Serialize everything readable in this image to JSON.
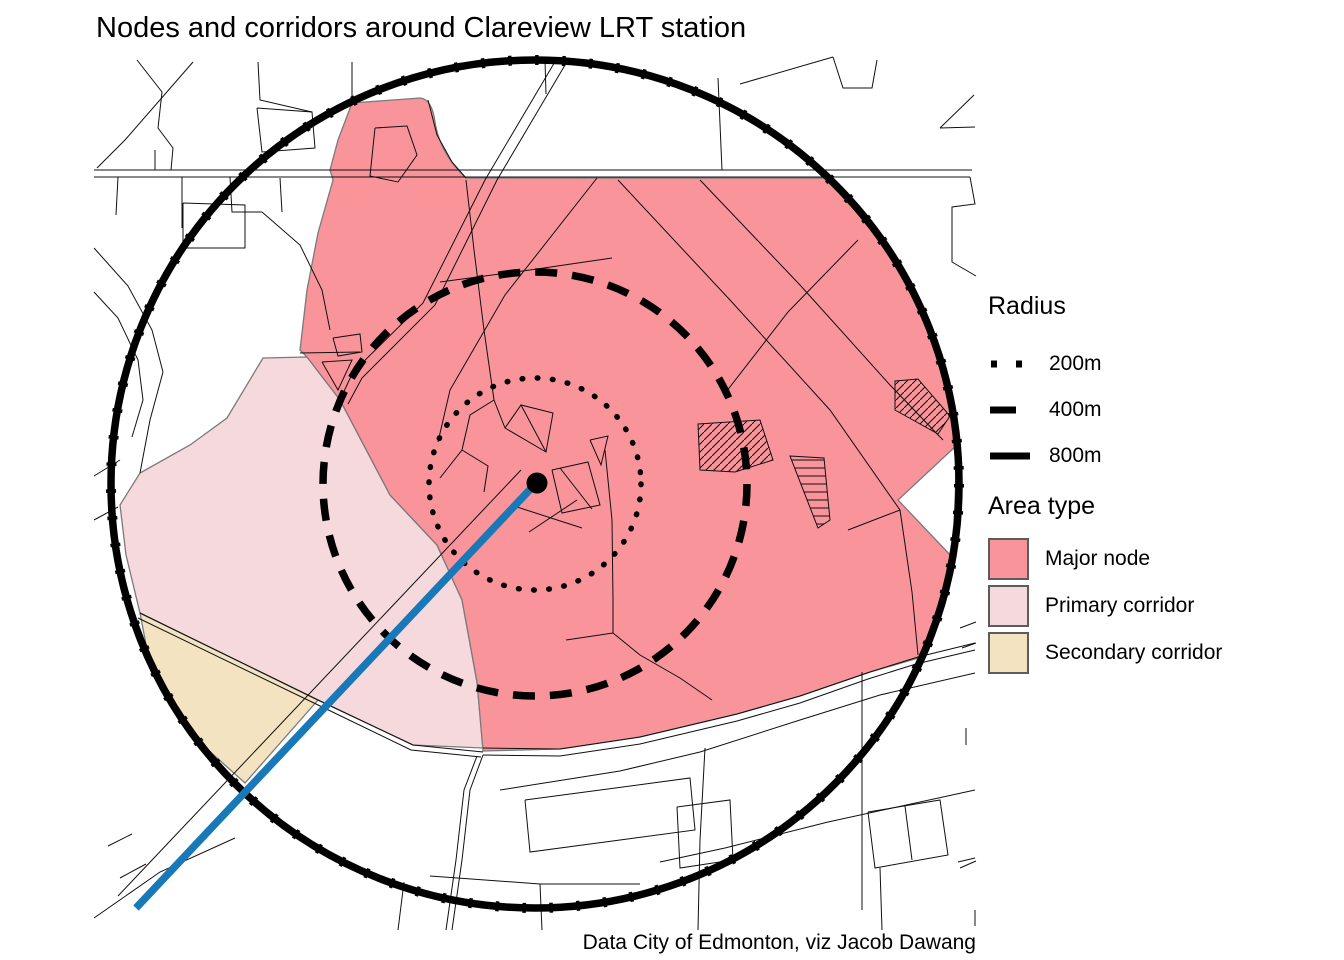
{
  "title": "Nodes and corridors around Clareview LRT station",
  "caption": "Data City of Edmonton, viz Jacob Dawang",
  "legend_radius": {
    "title": "Radius",
    "items": [
      {
        "label": "200m",
        "style": "dotted"
      },
      {
        "label": "400m",
        "style": "dashed"
      },
      {
        "label": "800m",
        "style": "solid"
      }
    ]
  },
  "legend_area": {
    "title": "Area type",
    "items": [
      {
        "label": "Major node",
        "color": "#F8949A"
      },
      {
        "label": "Primary corridor",
        "color": "#F6D9DD"
      },
      {
        "label": "Secondary corridor",
        "color": "#F3E3C1"
      }
    ]
  },
  "map": {
    "station_marker": "Clareview LRT station",
    "rings_m": {
      "dotted": 200,
      "dashed": 400,
      "solid": 800
    },
    "colors": {
      "major_node": "#F8949A",
      "primary_corridor": "#F6D9DD",
      "secondary_corridor": "#F3E3C1",
      "lrt_line": "#1878B8",
      "ring": "#000000",
      "street": "#101010",
      "area_outline": "#7a7a7a"
    }
  }
}
